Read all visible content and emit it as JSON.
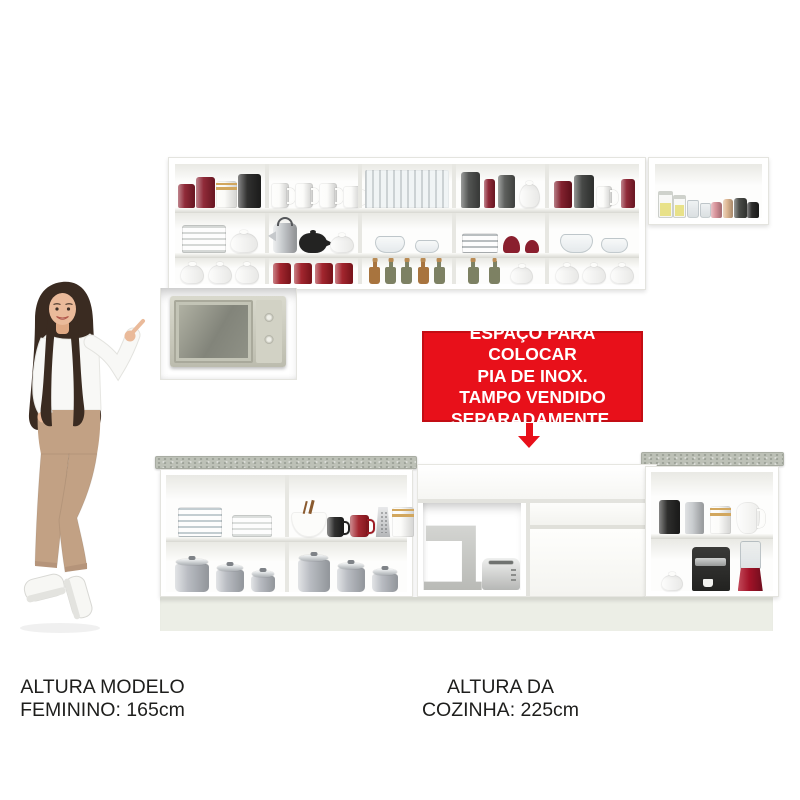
{
  "banner": {
    "line1": "ESPAÇO PARA COLOCAR",
    "line2": "PIA DE INOX.",
    "line3": "TAMPO VENDIDO",
    "line4": "SEPARADAMENTE.",
    "bg": "#e8101a",
    "border": "#c30d14",
    "text_color": "#ffffff",
    "arrow_icon": "arrow-down-icon"
  },
  "captions": {
    "model": {
      "line1": "ALTURA MODELO",
      "line2": "FEMININO: 165cm"
    },
    "kitchen": {
      "line1": "ALTURA DA",
      "line2": "COZINHA: 225cm"
    }
  },
  "palette": {
    "banner_red": "#e8101a",
    "banner_red_dark": "#c30d14",
    "granite": "#bdc1b7",
    "plinth": "#eceee6",
    "cabinet_line": "#e4e4df",
    "caption_text": "#1e1e1c",
    "skin": "#eaba9a",
    "hair": "#3a2b21",
    "pants": "#c2a184",
    "blouse": "#f8f8f6",
    "shoe": "#f7f7f4"
  },
  "upper_main": {
    "rows": [
      {
        "cells": [
          [
            {
              "t": "cyl",
              "c": "#8a1f2e",
              "w": 17,
              "h": 24
            },
            {
              "t": "cyl",
              "c": "#8a1f2e",
              "w": 19,
              "h": 31
            },
            {
              "t": "cylg",
              "c": "#fbfbf8",
              "c2": "#d2a75e",
              "w": 21,
              "h": 27
            },
            {
              "t": "cyl",
              "c": "#262625",
              "w": 23,
              "h": 34
            }
          ],
          [
            {
              "t": "mug",
              "c": "#fcfcfa",
              "w": 18,
              "h": 25
            },
            {
              "t": "mug",
              "c": "#fcfcfa",
              "w": 18,
              "h": 25
            },
            {
              "t": "mug",
              "c": "#fcfcfa",
              "w": 18,
              "h": 25
            },
            {
              "t": "mug",
              "c": "#fcfcfa",
              "w": 18,
              "h": 22
            }
          ],
          [
            {
              "t": "stems",
              "w": 84,
              "h": 38
            }
          ],
          [
            {
              "t": "cyl",
              "c": "#4a4c4a",
              "w": 19,
              "h": 36
            },
            {
              "t": "cyl",
              "c": "#8a1f2e",
              "w": 11,
              "h": 29
            },
            {
              "t": "cyl",
              "c": "#555754",
              "w": 17,
              "h": 33
            },
            {
              "t": "tureen",
              "c": "#fcfcfa",
              "w": 21,
              "h": 24
            }
          ],
          [
            {
              "t": "cyl",
              "c": "#7c1624",
              "w": 18,
              "h": 27
            },
            {
              "t": "cyl",
              "c": "#3d3f3d",
              "w": 20,
              "h": 33
            },
            {
              "t": "mug",
              "c": "#fcfcfa",
              "w": 16,
              "h": 22
            },
            {
              "t": "cyl",
              "c": "#8a1f2e",
              "w": 14,
              "h": 29
            }
          ]
        ]
      },
      {
        "cells": [
          [
            {
              "t": "plates",
              "c": "#d5d8d6",
              "w": 44,
              "h": 28
            },
            {
              "t": "tureen",
              "c": "#fcfcfa",
              "w": 28,
              "h": 20
            }
          ],
          [
            {
              "t": "kettle",
              "c": "#c6c9cc",
              "w": 24,
              "h": 30
            },
            {
              "t": "teapot",
              "c": "#232322",
              "w": 28,
              "h": 20
            },
            {
              "t": "tureen",
              "c": "#fcfcfa",
              "w": 24,
              "h": 17
            }
          ],
          [
            {
              "t": "glassbowl",
              "w": 30,
              "h": 17
            },
            {
              "t": "glassbowl",
              "w": 24,
              "h": 13
            }
          ],
          [
            {
              "t": "plates",
              "c": "#b9bec0",
              "w": 36,
              "h": 20
            },
            {
              "t": "pbowl",
              "c": "#8a1f2e",
              "w": 17,
              "h": 17
            },
            {
              "t": "pbowl",
              "c": "#8a1f2e",
              "w": 14,
              "h": 13
            }
          ],
          [
            {
              "t": "glassbowl",
              "w": 33,
              "h": 19
            },
            {
              "t": "glassbowl",
              "w": 27,
              "h": 15
            }
          ]
        ]
      },
      {
        "cells": [
          [
            {
              "t": "tureen",
              "c": "#fcfcfa",
              "w": 24,
              "h": 19
            },
            {
              "t": "tureen",
              "c": "#fcfcfa",
              "w": 24,
              "h": 19
            },
            {
              "t": "tureen",
              "c": "#fcfcfa",
              "w": 24,
              "h": 19
            }
          ],
          [
            {
              "t": "cyl",
              "c": "#9e1b24",
              "w": 18,
              "h": 21
            },
            {
              "t": "cyl",
              "c": "#9e1b24",
              "w": 18,
              "h": 21
            },
            {
              "t": "cyl",
              "c": "#9e1b24",
              "w": 18,
              "h": 21
            },
            {
              "t": "cyl",
              "c": "#9e1b24",
              "w": 18,
              "h": 21
            }
          ],
          [
            {
              "t": "bottle",
              "c": "#a8743e",
              "w": 11,
              "h": 17
            },
            {
              "t": "bottle",
              "c": "#7d8163",
              "w": 11,
              "h": 17
            },
            {
              "t": "bottle",
              "c": "#7d8163",
              "w": 11,
              "h": 17
            },
            {
              "t": "bottle",
              "c": "#a8743e",
              "w": 11,
              "h": 17
            },
            {
              "t": "bottle",
              "c": "#7d8163",
              "w": 11,
              "h": 17
            }
          ],
          [
            {
              "t": "bottle",
              "c": "#7d8163",
              "w": 11,
              "h": 17
            },
            {
              "t": "bottle",
              "c": "#7d8163",
              "w": 11,
              "h": 17
            },
            {
              "t": "tureen",
              "c": "#fcfcfa",
              "w": 23,
              "h": 17
            }
          ],
          [
            {
              "t": "tureen",
              "c": "#fcfcfa",
              "w": 24,
              "h": 18
            },
            {
              "t": "tureen",
              "c": "#fcfcfa",
              "w": 24,
              "h": 18
            },
            {
              "t": "tureen",
              "c": "#fcfcfa",
              "w": 24,
              "h": 18
            }
          ]
        ]
      }
    ]
  },
  "upper_right": {
    "items": [
      {
        "t": "jar",
        "c": "#e7df7d",
        "w": 15,
        "h": 26
      },
      {
        "t": "jar",
        "c": "#e7df7d",
        "w": 13,
        "h": 22
      },
      {
        "t": "glass",
        "w": 12,
        "h": 18
      },
      {
        "t": "glass",
        "w": 11,
        "h": 15
      },
      {
        "t": "cyl",
        "c": "#d78f97",
        "w": 11,
        "h": 16
      },
      {
        "t": "candle",
        "c": "#ddb58f",
        "w": 10,
        "h": 19
      },
      {
        "t": "cyl",
        "c": "#41433f",
        "w": 13,
        "h": 20
      },
      {
        "t": "cyl",
        "c": "#232322",
        "w": 12,
        "h": 16
      }
    ]
  },
  "lower_left": {
    "rows": [
      {
        "cells": [
          [
            {
              "t": "plates",
              "c": "#c3cdd1",
              "w": 44,
              "h": 30
            },
            {
              "t": "plates",
              "c": "#dcdfdd",
              "w": 40,
              "h": 22
            }
          ],
          [
            {
              "t": "bowlsp",
              "c": "#fcfcfa",
              "c2": "#8a5a2e",
              "w": 36,
              "h": 25
            },
            {
              "t": "mug",
              "c": "#232322",
              "w": 17,
              "h": 20
            },
            {
              "t": "mug",
              "c": "#9e1b24",
              "w": 19,
              "h": 22
            },
            {
              "t": "grater",
              "c": "#cdd0d2",
              "w": 17,
              "h": 30
            },
            {
              "t": "cylg",
              "c": "#fcfcfa",
              "c2": "#d2a75e",
              "w": 22,
              "h": 30
            }
          ]
        ]
      },
      {
        "cells": [
          [
            {
              "t": "pot",
              "c": "#b9bcc2",
              "w": 34,
              "h": 28
            },
            {
              "t": "pot",
              "c": "#b9bcc2",
              "w": 28,
              "h": 22
            },
            {
              "t": "pot",
              "c": "#b9bcc2",
              "w": 24,
              "h": 16
            }
          ],
          [
            {
              "t": "pot",
              "c": "#b9bcc2",
              "w": 32,
              "h": 32
            },
            {
              "t": "pot",
              "c": "#b9bcc2",
              "w": 28,
              "h": 24
            },
            {
              "t": "pot",
              "c": "#b9bcc2",
              "w": 26,
              "h": 18
            }
          ]
        ]
      }
    ]
  },
  "sink_niche": {
    "items": [
      {
        "t": "mixer",
        "c": "#c9cac6",
        "w": 58,
        "h": 70
      },
      {
        "t": "toaster",
        "c": "#d8d9d7",
        "w": 38,
        "h": 32
      }
    ]
  },
  "lower_right": {
    "rows": [
      {
        "cells": [
          [
            {
              "t": "cyl",
              "c": "#232322",
              "w": 21,
              "h": 34
            },
            {
              "t": "cyl",
              "c": "#c6c9cc",
              "w": 19,
              "h": 32
            },
            {
              "t": "cylg",
              "c": "#fcfcfa",
              "c2": "#d2a75e",
              "w": 21,
              "h": 28
            },
            {
              "t": "jug",
              "c": "#fcfcfa",
              "w": 24,
              "h": 32
            }
          ]
        ]
      },
      {
        "cells": [
          [
            {
              "t": "tureen",
              "c": "#fcfcfa",
              "w": 22,
              "h": 16
            },
            {
              "t": "coffee",
              "c": "#2b2b29",
              "w": 38,
              "h": 44
            },
            {
              "t": "blender",
              "c": "#a31328",
              "w": 25,
              "h": 50
            }
          ]
        ]
      }
    ]
  }
}
